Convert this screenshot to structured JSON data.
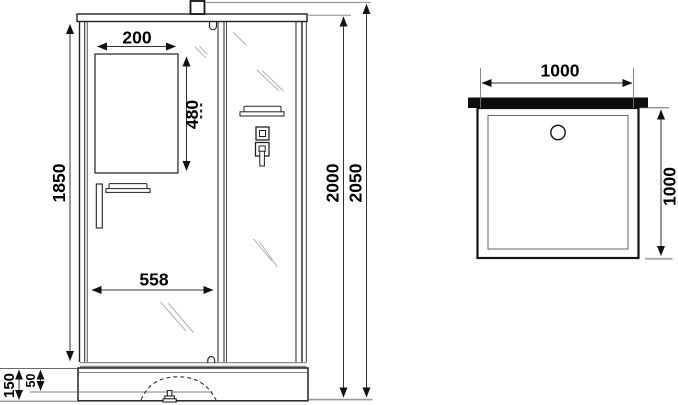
{
  "drawing_title": "shower-cabin-dimension-drawing",
  "front_view": {
    "dimensions": {
      "mirror_width": "200",
      "mirror_height": "480",
      "door_opening_height": "1850",
      "door_width": "558",
      "cabin_height": "2000",
      "overall_height": "2050",
      "tray_height": "150",
      "tray_rim_height": "50"
    }
  },
  "top_view": {
    "dimensions": {
      "width": "1000",
      "depth": "1000"
    }
  },
  "colors": {
    "line": "#1a1a1a",
    "gray_line": "#999999",
    "background": "#ffffff",
    "back_wall_fill": "#0d0d0d"
  }
}
